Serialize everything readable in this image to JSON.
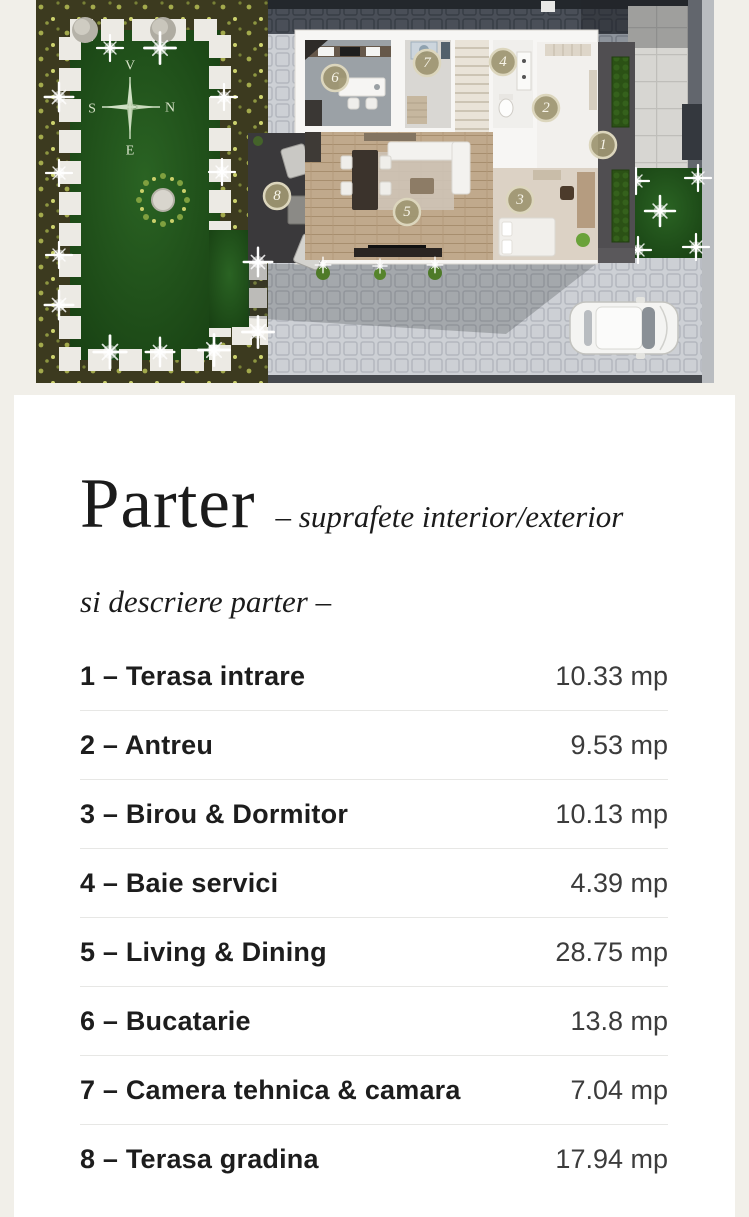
{
  "plan": {
    "compass": {
      "up": "V",
      "right": "N",
      "left": "S",
      "down": "E"
    },
    "markers": [
      "1",
      "2",
      "3",
      "4",
      "5",
      "6",
      "7",
      "8"
    ],
    "colors": {
      "marker_fill": "#9e9671",
      "marker_ring": "#dcd6bd",
      "lawn_green": "#1d4f1a",
      "deck_gray": "#3a393b",
      "paver_light": "#cdd0d5"
    }
  },
  "card": {
    "title": "Parter",
    "subtitle": "– suprafete interior/exterior",
    "tagline": "si descriere parter –",
    "rooms": [
      {
        "label": "1 – Terasa intrare",
        "area": "10.33 mp"
      },
      {
        "label": "2 – Antreu",
        "area": "9.53 mp"
      },
      {
        "label": "3 – Birou & Dormitor",
        "area": "10.13 mp"
      },
      {
        "label": "4 – Baie servici",
        "area": "4.39 mp"
      },
      {
        "label": "5 – Living & Dining",
        "area": "28.75 mp"
      },
      {
        "label": "6 – Bucatarie",
        "area": "13.8 mp"
      },
      {
        "label": "7 – Camera tehnica & camara",
        "area": "7.04 mp"
      },
      {
        "label": "8 – Terasa gradina",
        "area": "17.94 mp"
      }
    ]
  }
}
